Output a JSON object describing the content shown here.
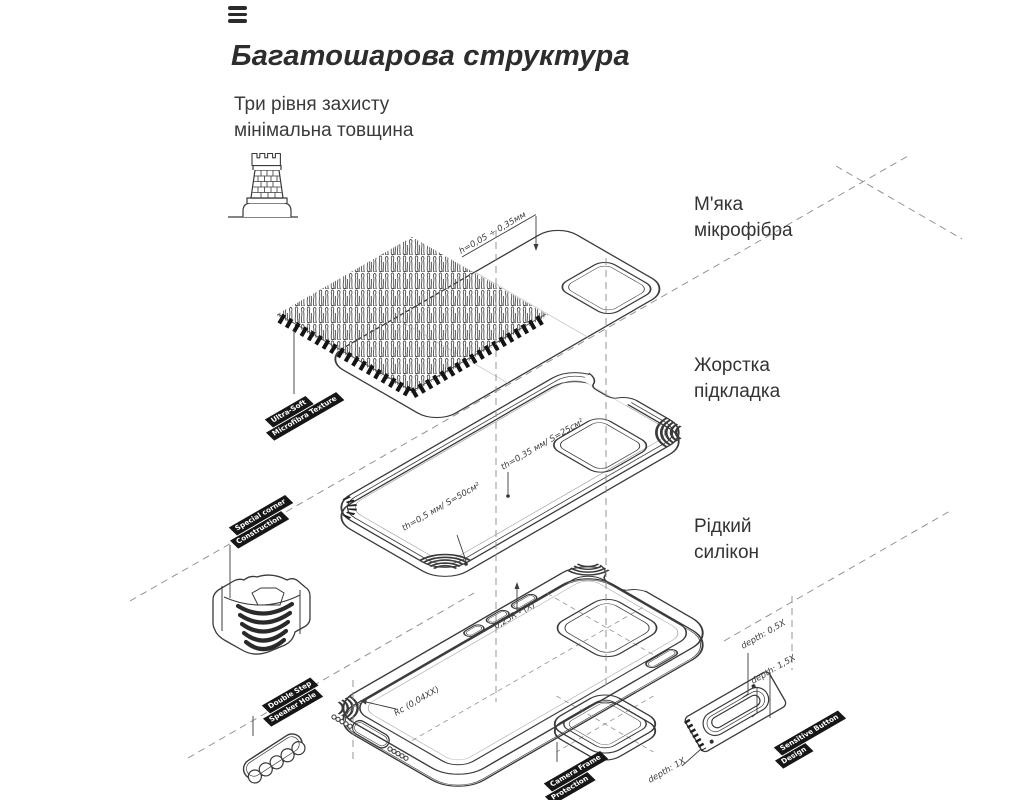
{
  "header": {
    "title": "Багатошарова структура",
    "subtitle_line1": "Три рівня захисту",
    "subtitle_line2": "мінімальна товщина"
  },
  "labels": {
    "layer1_line1": "М'яка",
    "layer1_line2": "мікрофібра",
    "layer2_line1": "Жорстка",
    "layer2_line2": "підкладка",
    "layer3_line1": "Рідкий",
    "layer3_line2": "силікон"
  },
  "badges": {
    "microfiber_line1": "Ultra-Soft",
    "microfiber_line2": "Microfibra Texture",
    "corner_line1": "Special corner",
    "corner_line2": "Construction",
    "speaker_line1": "Double Step",
    "speaker_line2": "Speaker Hole",
    "camera_line1": "Camera Frame",
    "camera_line2": "Protection",
    "button_line1": "Sensitive Button",
    "button_line2": "Design"
  },
  "annotations": {
    "sheet_thickness": "h=0,05 ÷ 0,35мм",
    "lining_thickness_small": "th=0,35 мм/ S=25см²",
    "lining_thickness_large": "th=0,5 мм/ S=50см²",
    "button_radius": "0,25R - (X)°",
    "floor_radius": "Rc (0,04XX)",
    "depth_small": "depth: 0,5X",
    "depth_large": "depth: 1,5X",
    "depth_mid": "depth: 1X"
  },
  "icons": {
    "menu": "hamburger-icon",
    "tower": "castle-tower-icon"
  },
  "colors": {
    "line": "#3a3a3a",
    "badge_bg": "#161616",
    "badge_text": "#ffffff",
    "text": "#333333",
    "dash": "#8a8a8a"
  }
}
